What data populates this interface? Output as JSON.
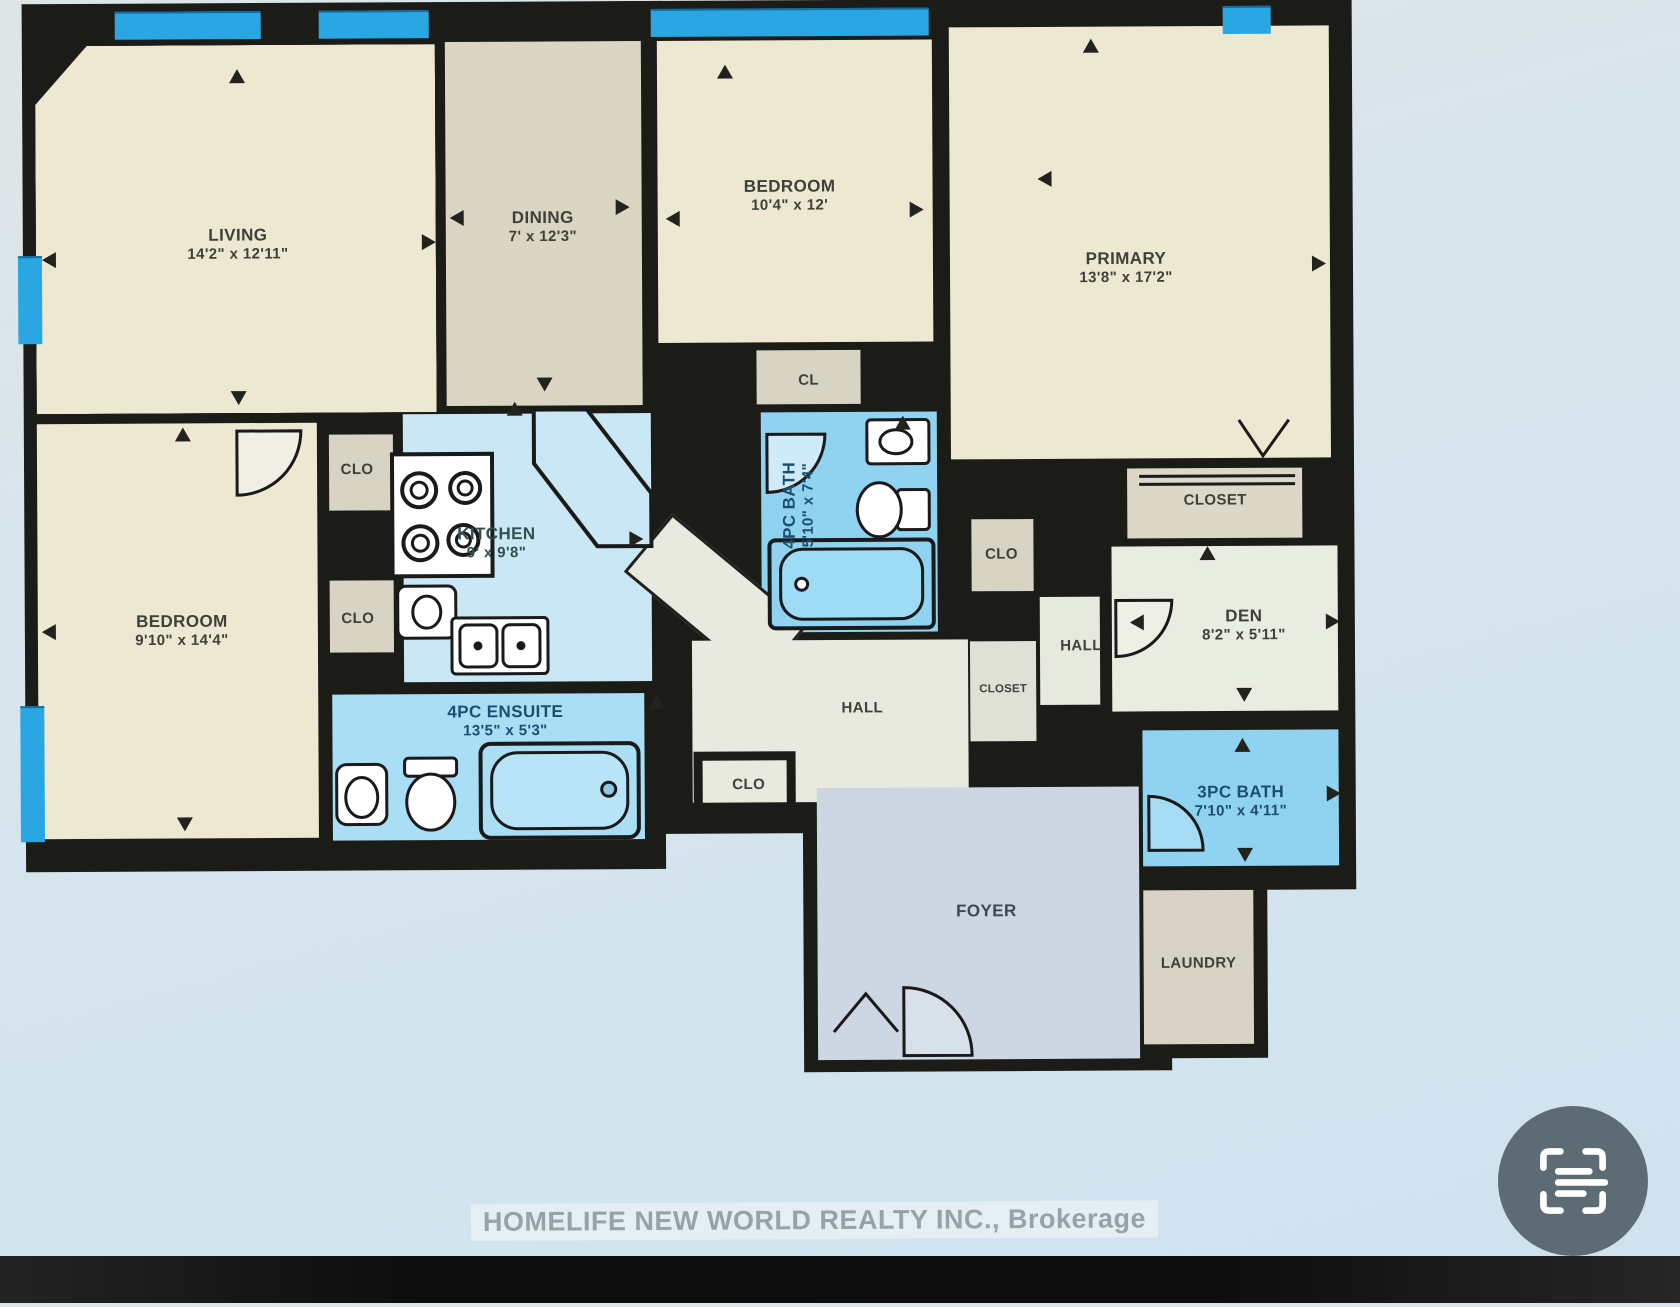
{
  "plan": {
    "rooms": {
      "living": {
        "name": "LIVING",
        "dims": "14'2\" x 12'11\""
      },
      "dining": {
        "name": "DINING",
        "dims": "7' x 12'3\""
      },
      "bedroom_top": {
        "name": "BEDROOM",
        "dims": "10'4\" x 12'"
      },
      "primary": {
        "name": "PRIMARY",
        "dims": "13'8\" x 17'2\""
      },
      "bedroom_left": {
        "name": "BEDROOM",
        "dims": "9'10\" x 14'4\""
      },
      "kitchen": {
        "name": "KITCHEN",
        "dims": "9' x 9'8\""
      },
      "bath_4pc": {
        "name": "4PC BATH",
        "dims": "5'10\" x 7'4\""
      },
      "ensuite_4pc": {
        "name": "4PC ENSUITE",
        "dims": "13'5\" x 5'3\""
      },
      "bath_3pc": {
        "name": "3PC BATH",
        "dims": "7'10\" x 4'11\""
      },
      "den": {
        "name": "DEN",
        "dims": "8'2\" x 5'11\""
      },
      "foyer": {
        "name": "FOYER"
      },
      "laundry": {
        "name": "LAUNDRY"
      },
      "cl": {
        "name": "CL"
      },
      "clo_kitchen_upper": {
        "name": "CLO"
      },
      "clo_kitchen_lower": {
        "name": "CLO"
      },
      "clo_hall": {
        "name": "CLO"
      },
      "clo_right": {
        "name": "CLO"
      },
      "closet_primary": {
        "name": "CLOSET"
      },
      "closet_hall": {
        "name": "CLOSET"
      },
      "hall_center": {
        "name": "HALL"
      },
      "hall_right": {
        "name": "HALL"
      }
    },
    "watermark": "HOMELIFE NEW WORLD REALTY INC., Brokerage"
  },
  "icons": {
    "live_text": "live-text-icon"
  },
  "colors": {
    "wall": "#1b1b18",
    "window_blue": "#2aa6e3",
    "room_cream": "#ece8d1",
    "room_gray_beige": "#dad6c3",
    "room_closet_gray": "#d8d4c4",
    "kitchen_blue": "#cae7f6",
    "bath_blue": "#8fd3f1",
    "ensuite_blue": "#a9def5",
    "hall_pale": "#e8eadf",
    "foyer_blue_gray": "#ccd7e3",
    "photo_background": "#d6e4ee",
    "watermark_text": "#97a1a9",
    "live_text_button": "#5d6b74"
  }
}
